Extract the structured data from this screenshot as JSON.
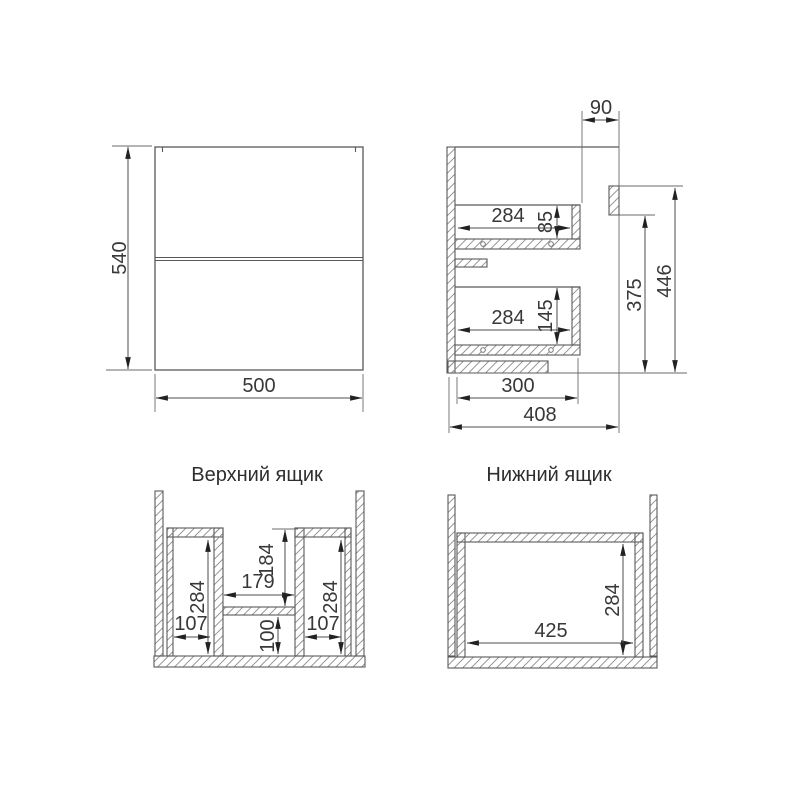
{
  "drawing": {
    "front_view": {
      "height_dim": "540",
      "width_dim": "500"
    },
    "side_view": {
      "top_overhang_dim": "90",
      "upper_drawer_depth_dim": "284",
      "upper_drawer_height_dim": "85",
      "lower_drawer_depth_dim": "284",
      "lower_drawer_height_dim": "145",
      "bracket_to_bottom_dim": "375",
      "top_to_bottom_dim": "446",
      "bottom_panel_depth_dim": "300",
      "total_depth_dim": "408"
    },
    "upper_drawer_view": {
      "title": "Верхний ящик",
      "left_inner_height_dim": "284",
      "left_inner_width_dim": "107",
      "center_gap_width_dim": "179",
      "center_depth_dim": "184",
      "center_bottom_height_dim": "100",
      "right_inner_height_dim": "284",
      "right_inner_width_dim": "107"
    },
    "lower_drawer_view": {
      "title": "Нижний ящик",
      "inner_width_dim": "425",
      "inner_height_dim": "284"
    },
    "colors": {
      "background": "#ffffff",
      "outline": "#595959",
      "dimension_line": "#4d4d4d",
      "arrow": "#222222",
      "hatch": "#8c8c8c",
      "text": "#333333"
    }
  }
}
